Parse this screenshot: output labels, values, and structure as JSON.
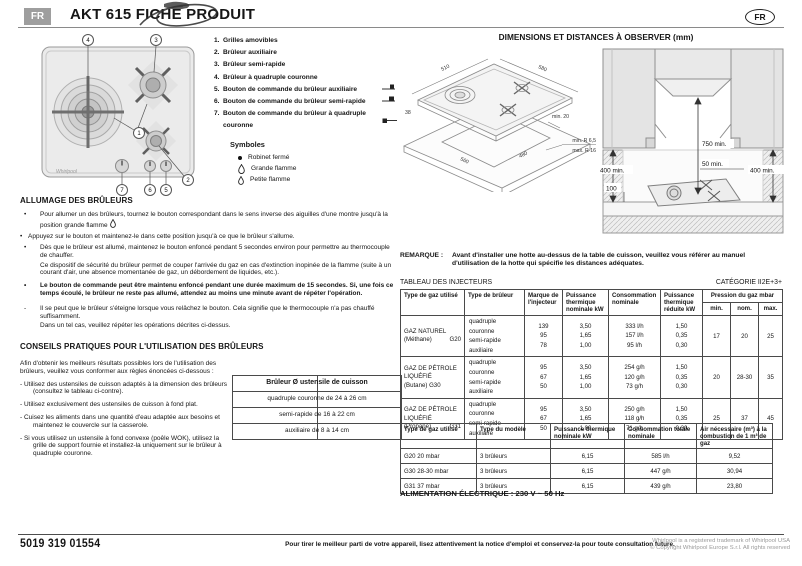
{
  "header": {
    "lang_badge": "FR",
    "title": "AKT 615 FICHE PRODUIT",
    "lang_stamp": "FR"
  },
  "hob": {
    "c1": "1",
    "c2": "2",
    "c3": "3",
    "c4": "4",
    "c5": "5",
    "c6": "6",
    "c7": "7",
    "logo": "Whirlpool"
  },
  "parts": {
    "items": [
      {
        "num": "1.",
        "label": "Grilles amovibles"
      },
      {
        "num": "2.",
        "label": "Brûleur auxiliaire"
      },
      {
        "num": "3.",
        "label": "Brûleur semi-rapide"
      },
      {
        "num": "4.",
        "label": "Brûleur à quadruple couronne"
      },
      {
        "num": "5.",
        "label": "Bouton de commande du brûleur auxiliaire"
      },
      {
        "num": "6.",
        "label": "Bouton de commande du brûleur semi-rapide"
      },
      {
        "num": "7.",
        "label": "Bouton de commande du brûleur à quadruple couronne"
      }
    ],
    "symbols_title": "Symboles",
    "symbols": [
      {
        "label": "Robinet fermé"
      },
      {
        "label": "Grande flamme"
      },
      {
        "label": "Petite flamme"
      }
    ]
  },
  "ignition": {
    "title": "ALLUMAGE DES BRÛLEURS",
    "marker": "•",
    "dash": "-",
    "b1": "Pour allumer un des brûleurs, tournez le bouton correspondant dans le sens inverse des aiguilles d'une montre jusqu'à la position grande flamme",
    "b2": "Appuyez sur le bouton et maintenez-le dans cette position jusqu'à ce que le brûleur s'allume.",
    "b3a": "Dès que le brûleur est allumé, maintenez le bouton enfoncé pendant 5 secondes environ pour permettre au thermocouple de chauffer.",
    "b3b": "Ce dispositif de sécurité du brûleur permet de couper l'arrivée du gaz en cas d'extinction inopinée de la flamme (suite à un courant d'air, une absence momentanée de gaz, un débordement de liquides, etc.).",
    "b4": "Le bouton de commande peut être maintenu enfoncé pendant une durée maximum de 15 secondes. Si, une fois ce temps écoulé, le brûleur ne reste pas allumé, attendez au moins une minute avant de répéter l'opération.",
    "b5a": "Il se peut que le brûleur s'éteigne lorsque vous relâchez le bouton. Cela signifie que le thermocouple n'a pas chauffé suffisamment.",
    "b5b": "Dans un tel cas, veuillez répéter les opérations décrites ci-dessus."
  },
  "tips": {
    "title": "CONSEILS PRATIQUES POUR L'UTILISATION DES BRÛLEURS",
    "intro": "Afin d'obtenir les meilleurs résultats possibles lors de l'utilisation des brûleurs, veuillez vous conformer aux règles énoncées ci-dessous :",
    "t1": "- Utilisez des ustensiles de cuisson adaptés à la dimension des brûleurs (consultez le tableau ci-contre).",
    "t2": "- Utilisez exclusivement des ustensiles de cuisson à fond plat.",
    "t3": "- Cuisez les aliments dans une quantité d'eau adaptée aux besoins et maintenez le couvercle sur la casserole.",
    "t4": "- Si vous utilisez un ustensile à fond convexe (poêle WOK), utilisez la grille de support fournie et installez-la uniquement sur le brûleur à quadruple couronne.",
    "pan_table": {
      "header": "Brûleur Ø ustensile de cuisson",
      "rows": [
        "quadruple couronne de 24 à 26 cm",
        "semi-rapide de 16 à 22 cm",
        "auxiliaire de 8 à 14 cm"
      ]
    }
  },
  "dimensions": {
    "title": "DIMENSIONS ET DISTANCES À OBSERVER (mm)",
    "iso": {
      "w": "510",
      "d": "580",
      "cut_w": "560",
      "cut_d": "480",
      "th": "38",
      "edge": "min. 20",
      "rmin": "min. R 6,5",
      "rmax": "max. R 16"
    },
    "hood": {
      "top": "750 min.",
      "back": "50 min.",
      "left": "400 min.",
      "right": "400 min.",
      "front": "100"
    }
  },
  "remark": {
    "label": "REMARQUE :",
    "text": "Avant d'installer une hotte au-dessus de la table de cuisson, veuillez vous référer au manuel d'utilisation de la hotte qui spécifie les distances adéquates."
  },
  "injectors": {
    "title": "TABLEAU DES INJECTEURS",
    "category": "CATÉGORIE II2E+3+",
    "col_gas": "Type de gaz utilisé",
    "col_burner": "Type de brûleur",
    "col_injector": "Marque de l'injecteur",
    "col_power": "Puissance thermique nominale kW",
    "col_consumption": "Consommation nominale",
    "col_reduced": "Puissance thermique réduite kW",
    "col_pressure": "Pression du gaz mbar",
    "col_min": "min.",
    "col_nom": "nom.",
    "col_max": "max.",
    "rows": [
      {
        "gas_line1": "GAZ NATUREL",
        "gas_line2": "(Méthane)",
        "gas_line3": "",
        "gas_code": "G20",
        "burners": [
          "quadruple couronne",
          "semi-rapide",
          "auxiliaire"
        ],
        "inj": [
          "139",
          "95",
          "78"
        ],
        "power": [
          "3,50",
          "1,65",
          "1,00"
        ],
        "cons": [
          "333 l/h",
          "157 l/h",
          "95 l/h"
        ],
        "red": [
          "1,50",
          "0,35",
          "0,30"
        ],
        "pmin": "17",
        "pnom": "20",
        "pmax": "25"
      },
      {
        "gas_line1": "GAZ DE PÉTROLE",
        "gas_line2": "LIQUÉFIÉ",
        "gas_line3": "(Butane) G30",
        "gas_code": "",
        "burners": [
          "quadruple couronne",
          "semi-rapide",
          "auxiliaire"
        ],
        "inj": [
          "95",
          "67",
          "50"
        ],
        "power": [
          "3,50",
          "1,65",
          "1,00"
        ],
        "cons": [
          "254 g/h",
          "120 g/h",
          "73 g/h"
        ],
        "red": [
          "1,50",
          "0,35",
          "0,30"
        ],
        "pmin": "20",
        "pnom": "28-30",
        "pmax": "35"
      },
      {
        "gas_line1": "GAZ DE PÉTROLE",
        "gas_line2": "LIQUÉFIÉ",
        "gas_line3": "(Propane)",
        "gas_code": "G31",
        "burners": [
          "quadruple couronne",
          "semi-rapide",
          "auxiliaire"
        ],
        "inj": [
          "95",
          "67",
          "50"
        ],
        "power": [
          "3,50",
          "1,65",
          "1,00"
        ],
        "cons": [
          "250 g/h",
          "118 g/h",
          "71 g/h"
        ],
        "red": [
          "1,50",
          "0,35",
          "0,30"
        ],
        "pmin": "25",
        "pnom": "37",
        "pmax": "45"
      }
    ]
  },
  "models": {
    "col_gas": "Type de gaz utilisé",
    "col_model": "Type du modèle",
    "col_power": "Puissance thermique nominale kW",
    "col_consumption": "Consommation totale nominale",
    "col_air": "Air nécessaire (m³) à la combustion de 1 m³ de gaz",
    "rows": [
      [
        "G20 20 mbar",
        "3 brûleurs",
        "6,15",
        "585 l/h",
        "9,52"
      ],
      [
        "G30 28-30 mbar",
        "3 brûleurs",
        "6,15",
        "447 g/h",
        "30,94"
      ],
      [
        "G31 37 mbar",
        "3 brûleurs",
        "6,15",
        "439 g/h",
        "23,80"
      ]
    ]
  },
  "power_supply": "ALIMENTATION ÉLECTRIQUE : 230 V ~ 50 Hz",
  "footer": {
    "code": "5019 319 01554",
    "notice": "Pour tirer le meilleur parti de votre appareil, lisez attentivement la notice d'emploi et conservez-la pour toute consultation future.",
    "copyright1": "Whirlpool is a registered trademark of Whirlpool USA",
    "copyright2": "© Copyright Whirlpool Europe S.r.l. All rights reserved"
  }
}
